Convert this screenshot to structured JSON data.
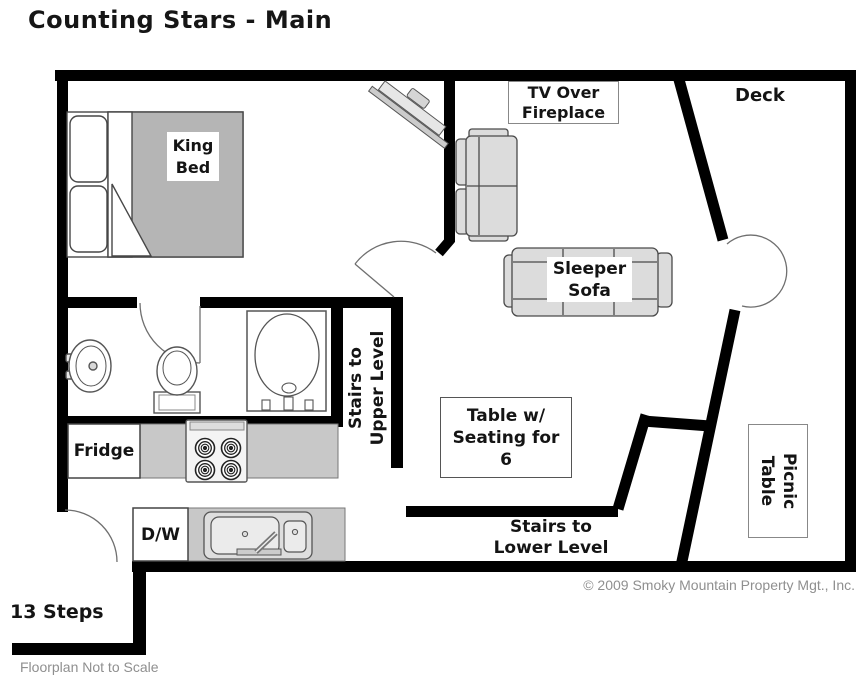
{
  "title": "Counting Stars - Main",
  "rooms": {
    "deck": "Deck",
    "stairs_upper": "Stairs to\nUpper Level",
    "stairs_lower": "Stairs to\nLower Level",
    "steps": "13 Steps"
  },
  "furniture": {
    "king_bed": "King\nBed",
    "tv_fireplace": "TV Over\nFireplace",
    "sleeper_sofa": "Sleeper\nSofa",
    "dining_table": "Table w/\nSeating for\n6",
    "picnic_table": "Picnic\nTable",
    "fridge": "Fridge",
    "dishwasher": "D/W"
  },
  "notes": {
    "copyright": "© 2009 Smoky Mountain Property Mgt., Inc.",
    "scale": "Floorplan Not to Scale"
  },
  "colors": {
    "wall": "#000000",
    "bed_gray": "#b5b5b5",
    "counter_gray": "#c8c8c8",
    "sofa_gray": "#dcdcdc",
    "note_gray": "#8f8f8f"
  }
}
